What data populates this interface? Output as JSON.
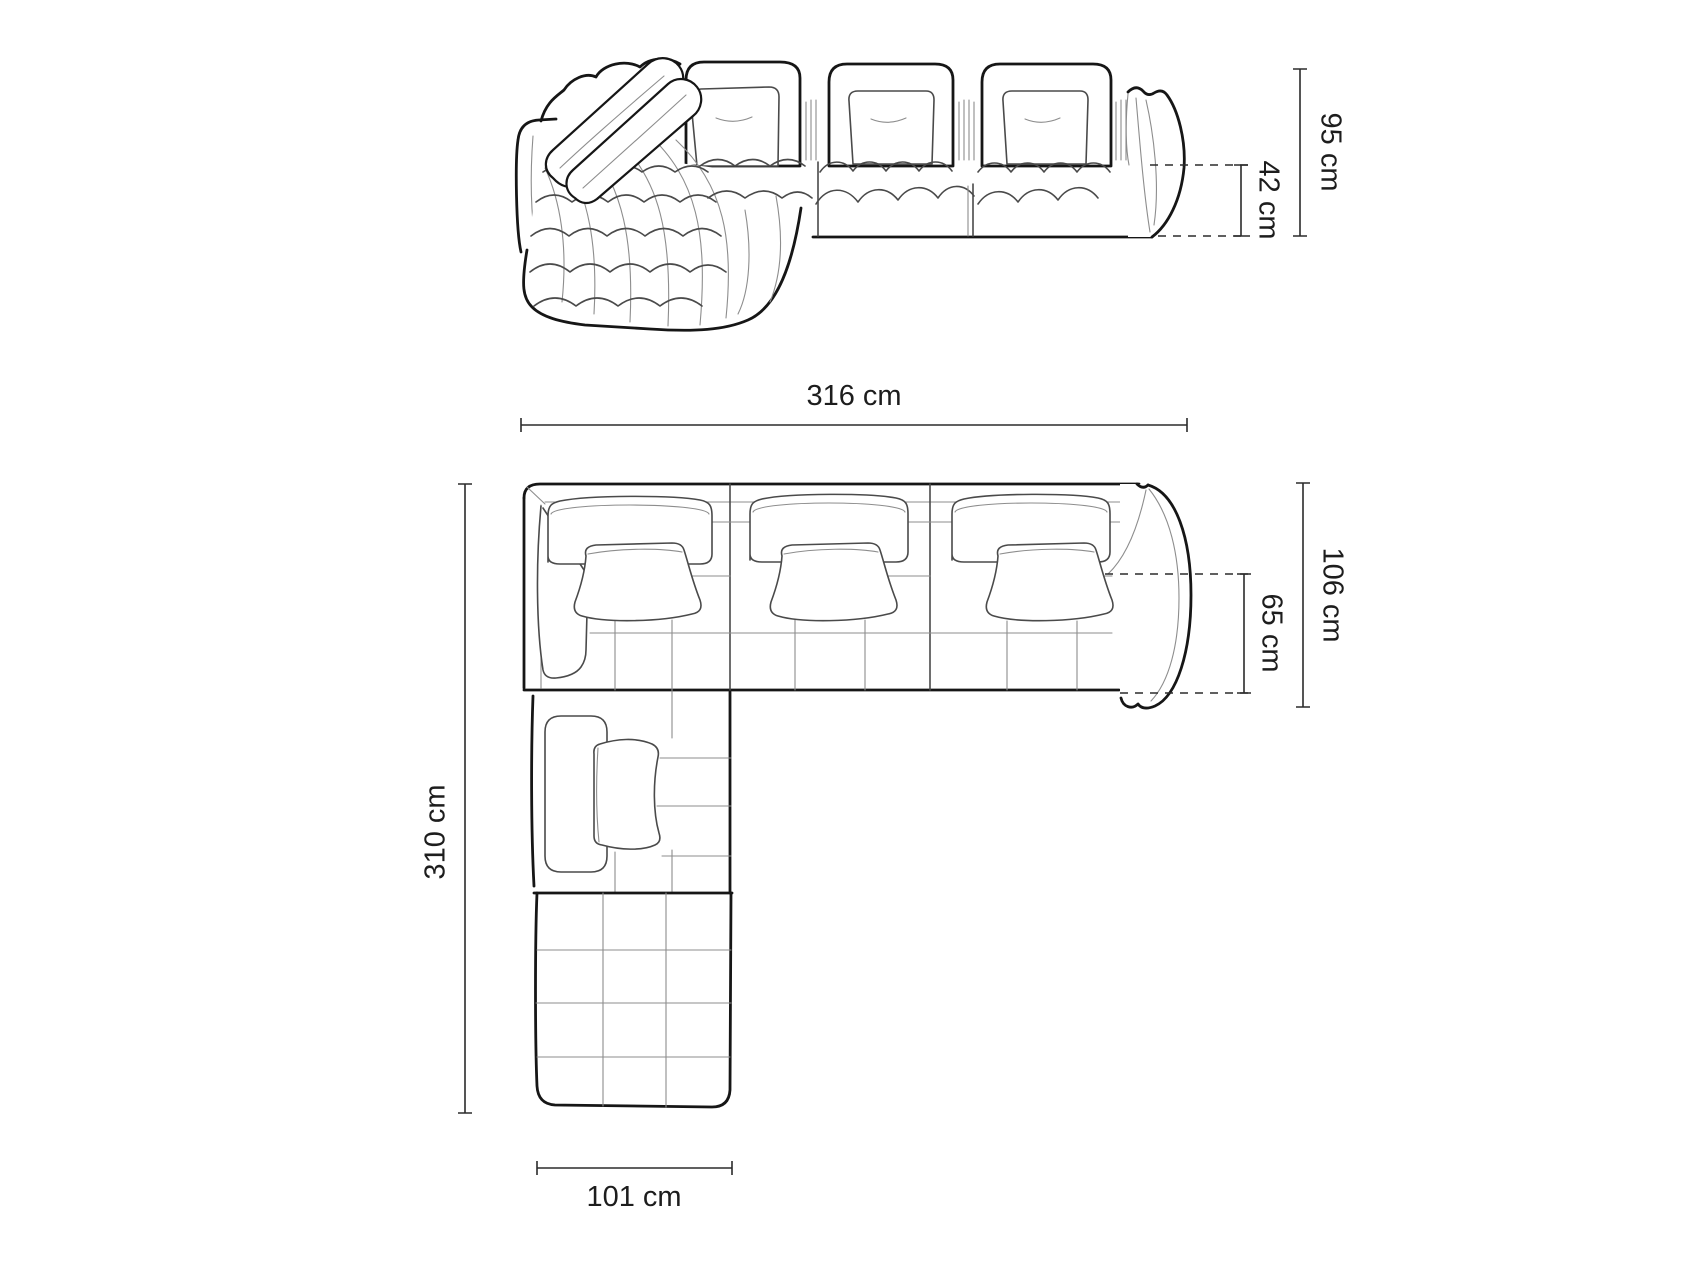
{
  "colors": {
    "background": "#ffffff",
    "outline": "#161616",
    "mid_line": "#4a4a4a",
    "light_line": "#8d8d8d",
    "dim_line": "#2b2b2b",
    "label_text": "#1d1d1d"
  },
  "front_view": {
    "dim_total_height": "95 cm",
    "dim_seat_height": "42 cm"
  },
  "plan_view": {
    "dim_total_width": "316 cm",
    "dim_total_depth": "310 cm",
    "dim_side_depth": "106 cm",
    "dim_seat_depth": "65 cm",
    "dim_chaise_width": "101 cm"
  }
}
